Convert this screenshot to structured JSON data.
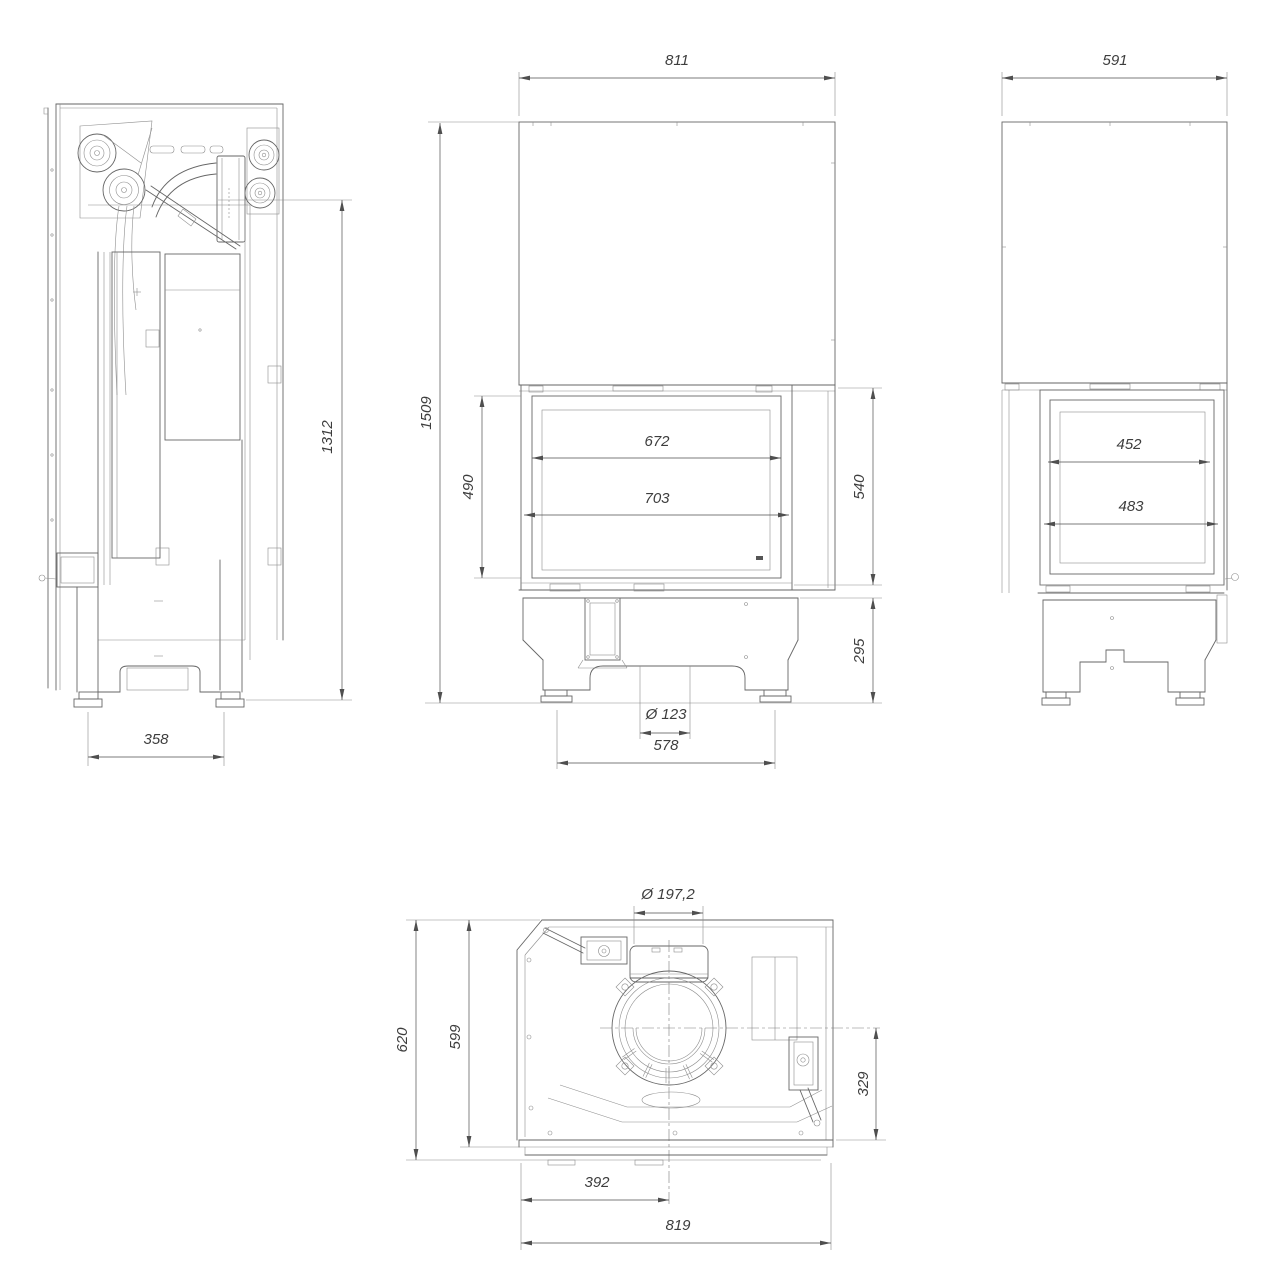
{
  "meta": {
    "drawing_type": "fireplace insert technical drawing",
    "background": "#ffffff",
    "line_color": "#666666",
    "dimension_color": "#4f4f4f",
    "text_color": "#3d3d3d"
  },
  "views": {
    "side": {
      "label": "left side view",
      "dim_height": "1312",
      "dim_base_width": "358"
    },
    "front": {
      "label": "front view",
      "dim_width_top": "811",
      "dim_total_height": "1509",
      "dim_glass_height": "490",
      "dim_glass_width": "672",
      "dim_opening_width": "703",
      "dim_door_height": "540",
      "dim_base_height": "295",
      "dim_outlet_diameter": "Ø 123",
      "dim_base_width": "578"
    },
    "side_right": {
      "label": "right side view",
      "dim_width_top": "591",
      "dim_glass_width": "452",
      "dim_opening_width": "483"
    },
    "top": {
      "label": "top view",
      "dim_flue_diameter": "Ø 197,2",
      "dim_depth_total": "620",
      "dim_depth_body": "599",
      "dim_flue_to_front": "329",
      "dim_flue_offset_left": "392",
      "dim_width_total": "819"
    }
  }
}
